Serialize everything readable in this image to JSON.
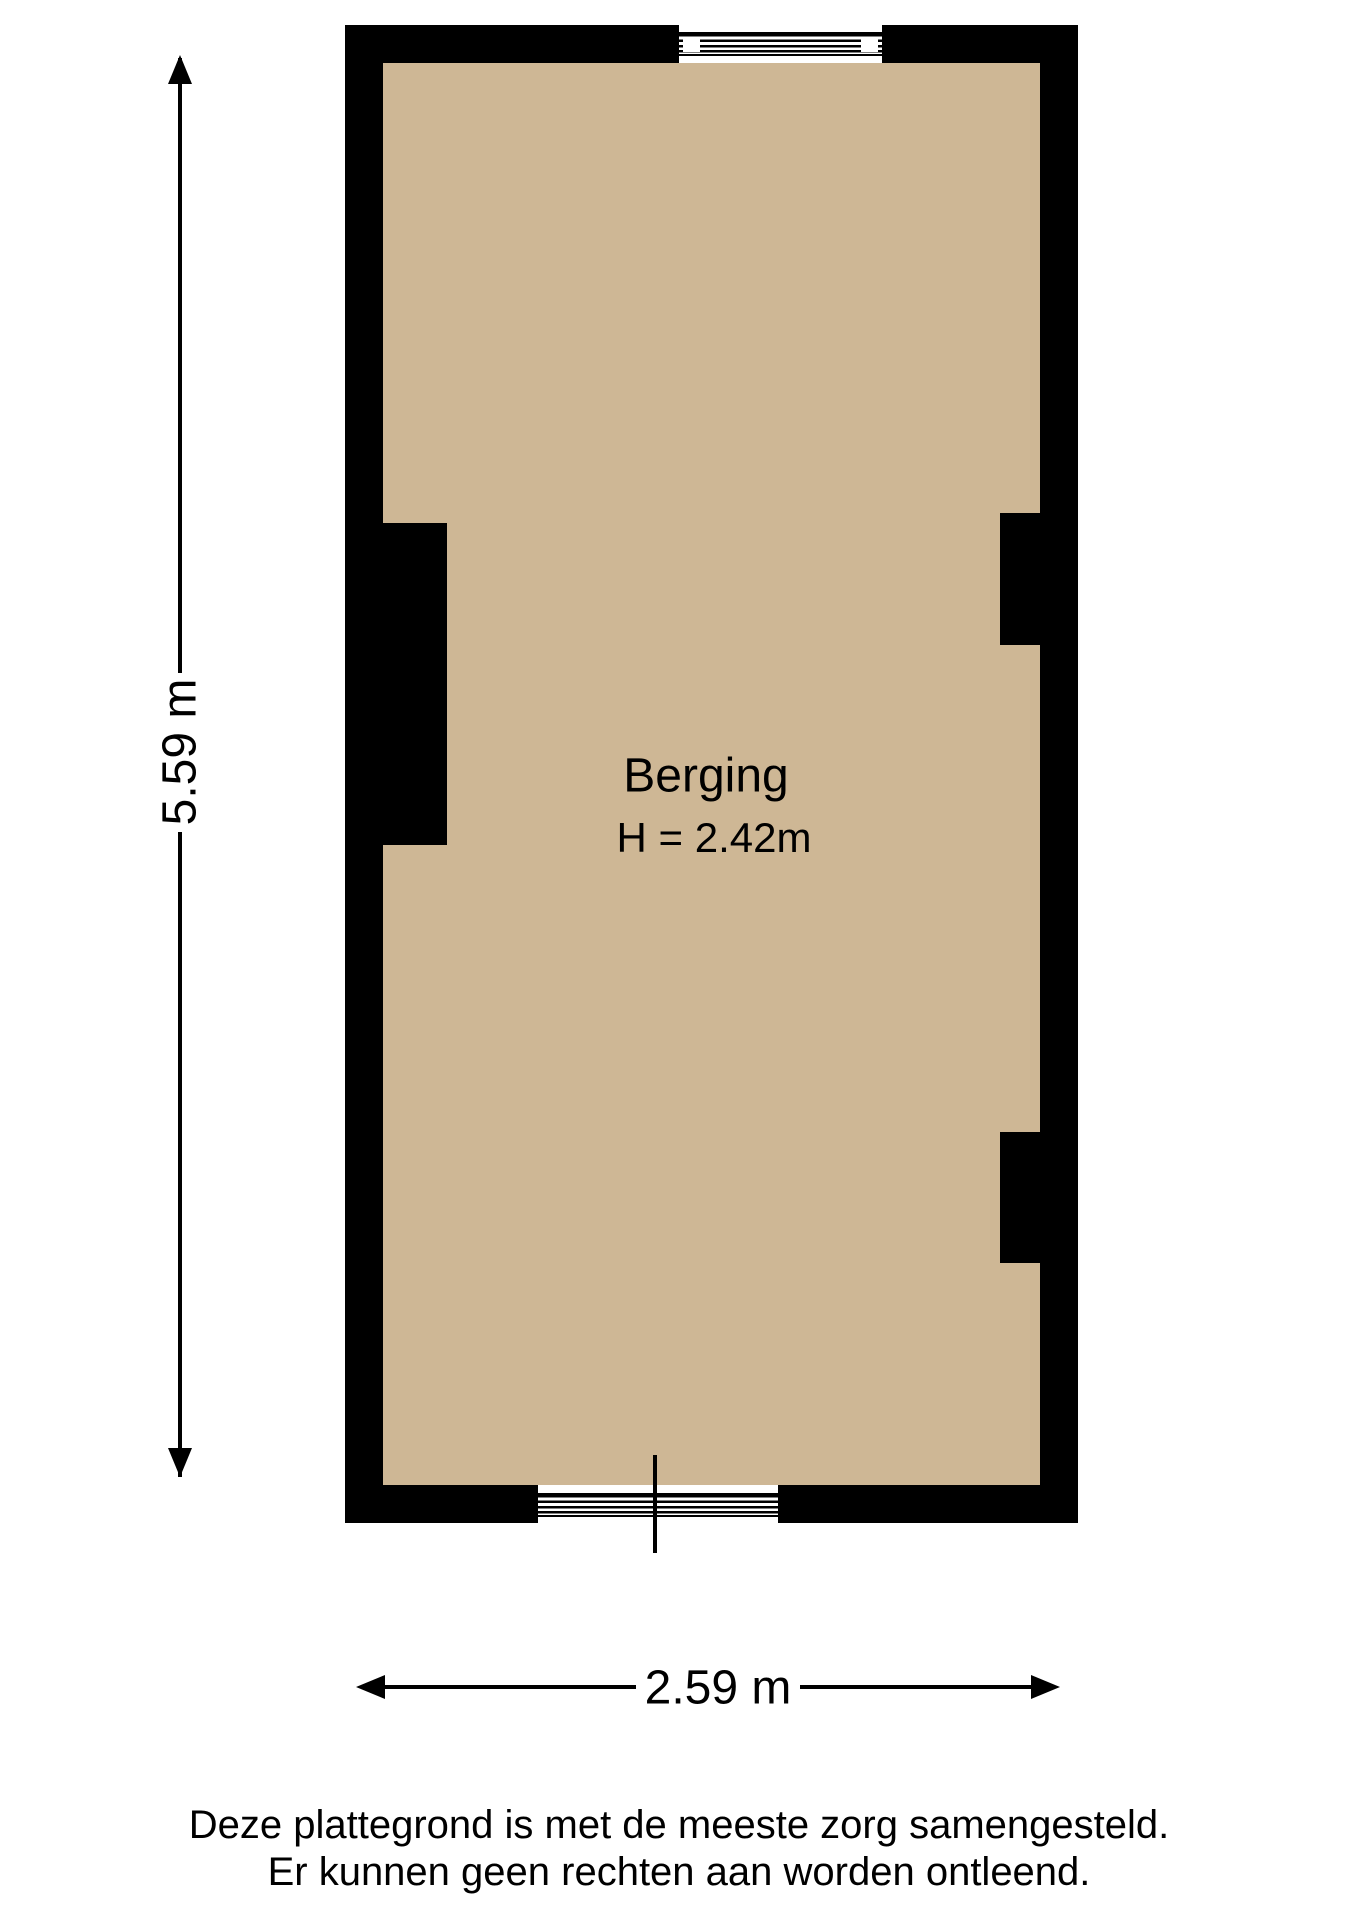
{
  "plan": {
    "room_label": "Berging",
    "room_height": "H = 2.42m",
    "dim_vertical": "5.59 m",
    "dim_horizontal": "2.59 m"
  },
  "disclaimer": {
    "line1": "Deze plattegrond is met de meeste zorg samengesteld.",
    "line2": "Er kunnen geen rechten aan worden ontleend."
  },
  "icons": {
    "arrow_up": "dimension-arrowhead-up",
    "arrow_down": "dimension-arrowhead-down",
    "arrow_left": "dimension-arrowhead-left",
    "arrow_right": "dimension-arrowhead-right"
  },
  "colors": {
    "wall": "#000000",
    "floor": "#ceb795",
    "background": "#ffffff",
    "text": "#000000"
  }
}
